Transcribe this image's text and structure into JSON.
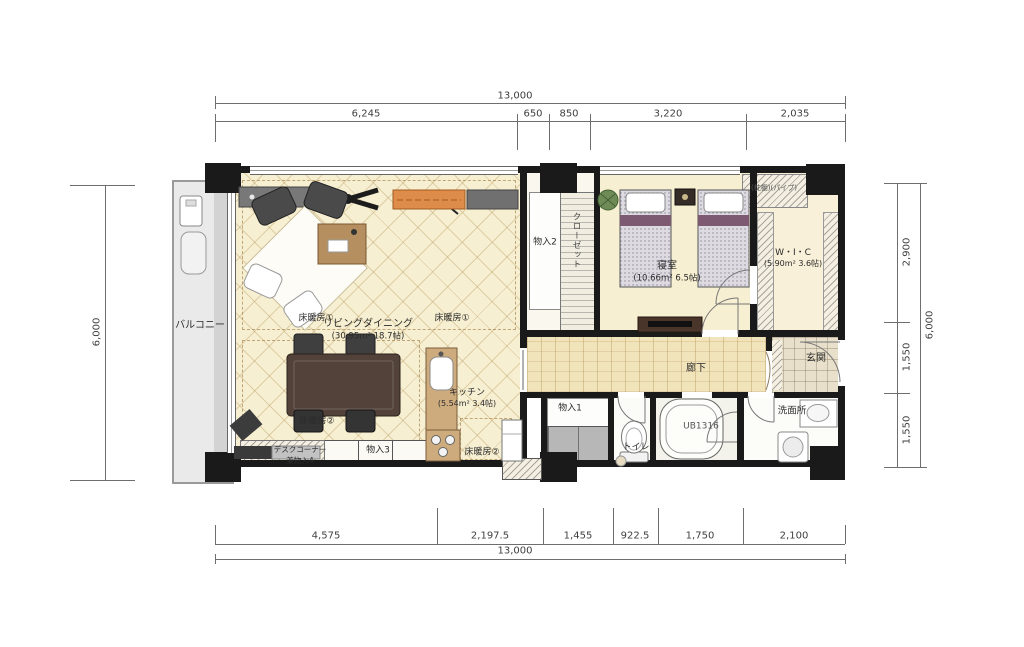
{
  "plan": {
    "dimensions": {
      "top": {
        "total": "13,000",
        "segments": [
          "6,245",
          "650",
          "850",
          "3,220",
          "2,035"
        ]
      },
      "bottom": {
        "total": "13,000",
        "segments": [
          "4,575",
          "2,197.5",
          "1,455",
          "922.5",
          "1,750",
          "2,100"
        ]
      },
      "left": {
        "total": "6,000"
      },
      "right": {
        "total": "6,000",
        "segments": [
          "2,900",
          "1,550",
          "1,550"
        ]
      }
    },
    "rooms": {
      "balcony": {
        "name": "バルコニー"
      },
      "living_dining": {
        "name": "リビングダイニング",
        "area": "(30.95m² 18.7帖)"
      },
      "kitchen": {
        "name": "キッチン",
        "area": "(5.54m² 3.4帖)"
      },
      "bedroom": {
        "name": "寝室",
        "area": "(10.66m² 6.5帖)"
      },
      "wic": {
        "name": "W・I・C",
        "area": "(5.90m² 3.6帖)",
        "shelf_note": "(枕棚)(パイプ)"
      },
      "hallway": {
        "name": "廊下"
      },
      "entrance": {
        "name": "玄関"
      },
      "washroom": {
        "name": "洗面所"
      },
      "unit_bath": {
        "name": "UB1316"
      },
      "toilet": {
        "name": "トイレ"
      },
      "storage1": {
        "name": "物入1"
      },
      "storage2": {
        "name": "物入2"
      },
      "storage3": {
        "name": "物入3"
      },
      "desk_corner": {
        "line1": "デスクコーナー",
        "line2": "兼物入4"
      },
      "closet": {
        "name": "クローゼット"
      }
    },
    "floor_heating": {
      "zone1": "床暖房①",
      "zone2": "床暖房②"
    },
    "colors": {
      "wall": "#1a1a1a",
      "floor_cream": "#f7efd1",
      "wood": "#f1e3ba",
      "tv_board_orange": "#de8c49",
      "bed_accent": "#7d5a72",
      "balcony_gray": "#eaeaea"
    }
  }
}
